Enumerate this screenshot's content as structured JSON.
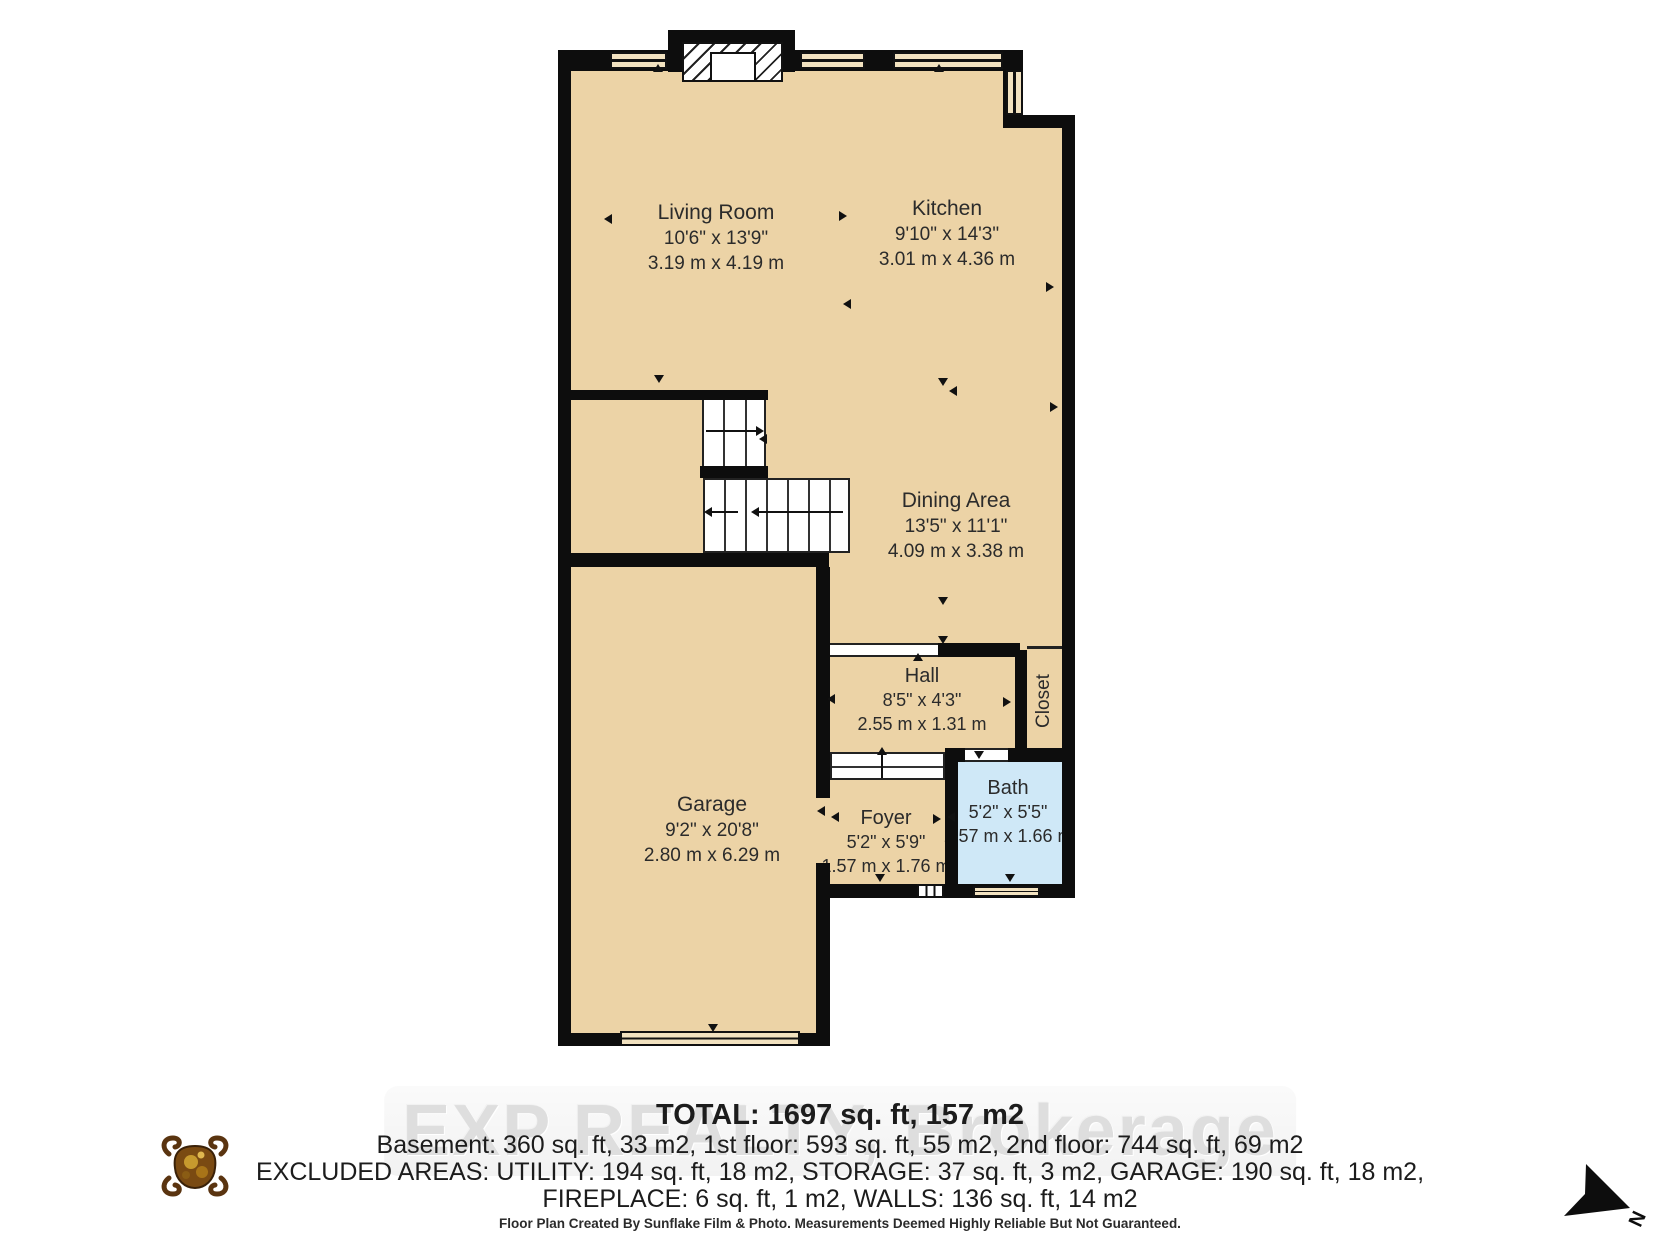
{
  "floorplan": {
    "rooms": {
      "living": {
        "name": "Living Room",
        "imperial": "10'6\" x 13'9\"",
        "metric": "3.19 m x 4.19 m"
      },
      "kitchen": {
        "name": "Kitchen",
        "imperial": "9'10\" x 14'3\"",
        "metric": "3.01 m x 4.36 m"
      },
      "dining": {
        "name": "Dining Area",
        "imperial": "13'5\" x 11'1\"",
        "metric": "4.09 m x 3.38 m"
      },
      "hall": {
        "name": "Hall",
        "imperial": "8'5\" x 4'3\"",
        "metric": "2.55 m x 1.31 m"
      },
      "closet": {
        "name": "Closet"
      },
      "bath": {
        "name": "Bath",
        "imperial": "5'2\" x 5'5\"",
        "metric": "1.57 m x 1.66 m"
      },
      "foyer": {
        "name": "Foyer",
        "imperial": "5'2\" x 5'9\"",
        "metric": "1.57 m x 1.76 m"
      },
      "garage": {
        "name": "Garage",
        "imperial": "9'2\" x 20'8\"",
        "metric": "2.80 m x 6.29 m"
      }
    },
    "compass": {
      "label": "N"
    },
    "summary": {
      "total": "TOTAL: 1697 sq. ft, 157 m2",
      "floors": "Basement: 360 sq. ft, 33 m2, 1st floor: 593 sq. ft, 55 m2, 2nd floor: 744 sq. ft, 69 m2",
      "excluded1": "EXCLUDED AREAS: UTILITY: 194 sq. ft, 18 m2, STORAGE: 37 sq. ft, 3 m2, GARAGE: 190 sq. ft, 18 m2,",
      "excluded2": "FIREPLACE: 6 sq. ft, 1 m2, WALLS: 136 sq. ft, 14 m2"
    },
    "watermark": "EXP REALTY, Brokerage",
    "footer": "Floor Plan Created By Sunflake Film & Photo. Measurements Deemed Highly Reliable But Not Guaranteed.",
    "colors": {
      "floor": "#ecd3a6",
      "wall": "#0d0d0d",
      "bath_blue": "#cfe8f7",
      "window_fill": "#f2e2c0",
      "logo_gold": "#a87418"
    }
  }
}
